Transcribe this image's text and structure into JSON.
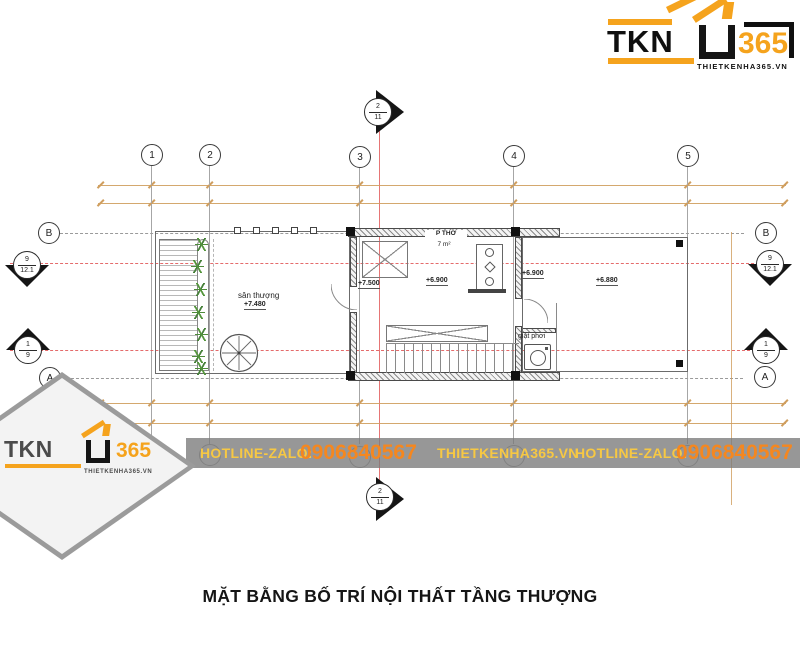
{
  "header_logo": {
    "brand": "TKN",
    "number": "365",
    "site": "THIETKENHA365.VN"
  },
  "watermark_logo": {
    "brand": "TKN",
    "number": "365",
    "site": "THIETKENHA365.VN"
  },
  "banner": {
    "hotline_label_left": "HOTLINE-ZALO:",
    "phone_left": "0906840567",
    "website": "THIETKENHA365.VN",
    "hotline_label_right": "HOTLINE-ZALO:",
    "phone_right": "0906840567"
  },
  "drawing_title": "MẶT BẰNG BỐ TRÍ NỘI THẤT TẦNG THƯỢNG",
  "plan": {
    "grid_columns": [
      "1",
      "2",
      "3",
      "4",
      "5"
    ],
    "grid_rows": {
      "top": "B",
      "bottom": "A"
    },
    "section_markers": {
      "top": {
        "num": "2",
        "sheet": "11"
      },
      "bottom": {
        "num": "2",
        "sheet": "11"
      },
      "left_upper": {
        "num": "9",
        "sheet": "12.1"
      },
      "left_lower": {
        "num": "1",
        "sheet": "9"
      },
      "right_upper": {
        "num": "9",
        "sheet": "12.1"
      },
      "right_lower": {
        "num": "1",
        "sheet": "9"
      }
    },
    "labels": {
      "terrace_name": "sân thượng",
      "terrace_level": "+7.480",
      "hall_level": "+7.500",
      "worship_room_name": "P THỜ",
      "worship_room_area": "7 m²",
      "worship_room_level": "+6.900",
      "laundry_level": "+6.900",
      "laundry_name": "giặt phơi",
      "rear_terrace_level": "+6.880"
    }
  },
  "colors": {
    "brand_orange": "#F5A31D",
    "banner_yellow": "#F7C843",
    "banner_phone_orange": "#F5871F",
    "section_line_red": "#E05252",
    "dimension_tan": "#CF9E5E"
  }
}
